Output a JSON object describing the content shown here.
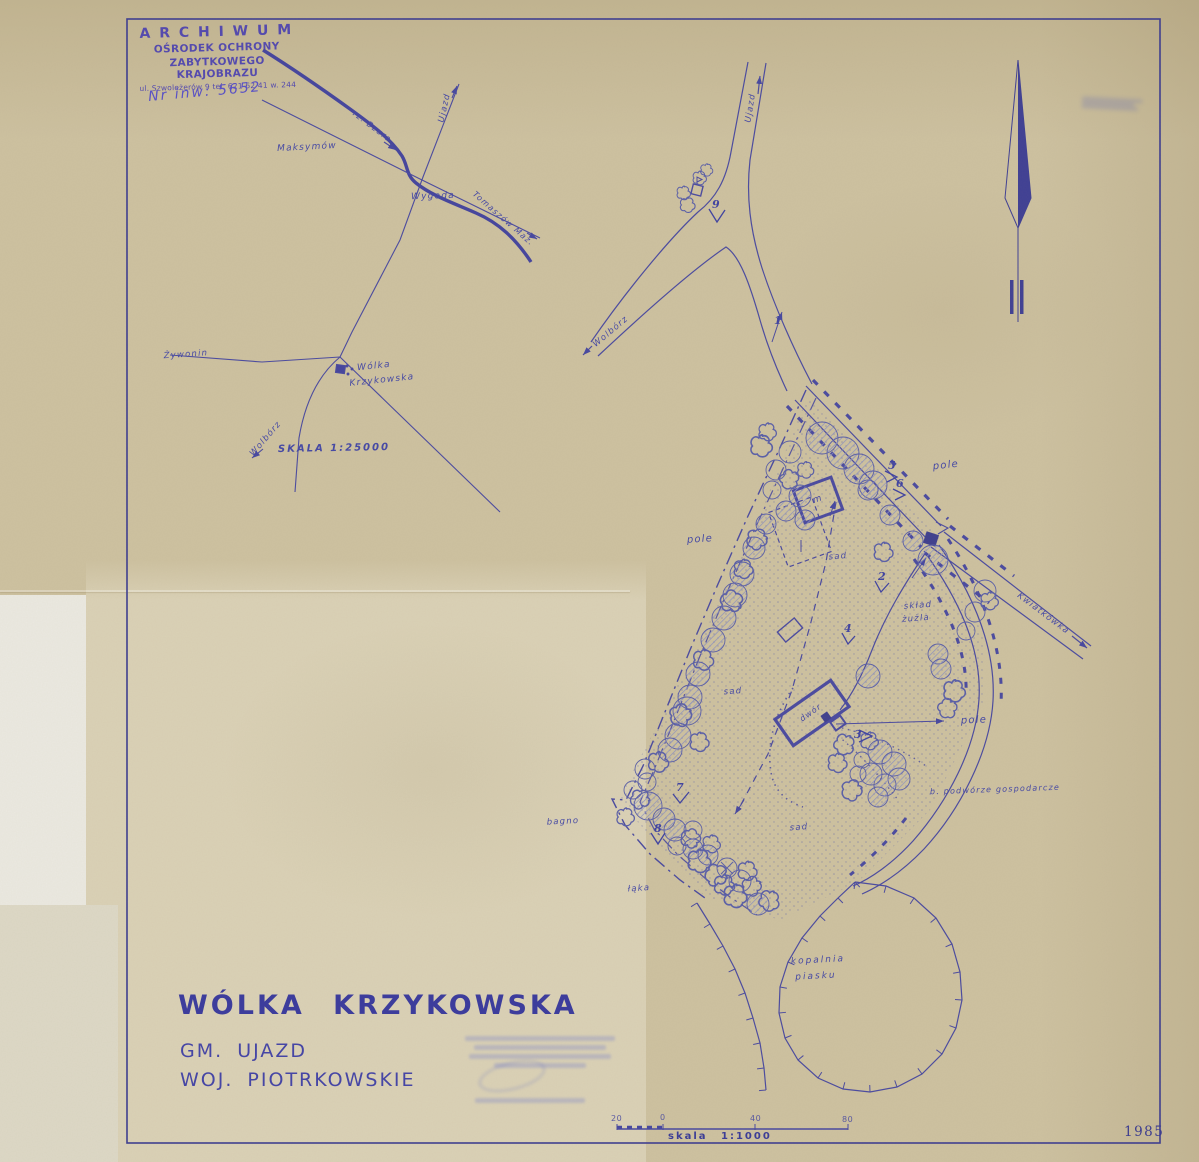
{
  "colors": {
    "paper": "#cdc1a0",
    "ink": "#4647a0",
    "title_ink": "#3d3d9c",
    "stamp_ink": "#4c42b0"
  },
  "archive_stamp": {
    "line1": "A R C H I W U M",
    "line2": "OŚRODEK OCHRONY",
    "line3": "ZABYTKOWEGO KRAJOBRAZU",
    "line4": "ul. Szwoleżerów 9  tel. 621 62 41 w. 244",
    "inventory_no": "Nr inw: 5652"
  },
  "sketch_map": {
    "scale_text": "SKALA  1:25000",
    "labels": {
      "maksymow": "Maksymów",
      "river": "rz. Bzura",
      "ujazd": "Ujazd",
      "wygoda": "Wygoda",
      "tomaszow": "Tomaszów Maz.",
      "zywonin": "Żywonin",
      "village_line1": "Wólka",
      "village_line2": "Krzykowska",
      "wolborz": "Wolbórz"
    }
  },
  "plan": {
    "road_labels": {
      "ujazd": "Ujazd",
      "wolborz": "Wolbórz",
      "kwiatkowka": "Kwiatkówka"
    },
    "area_labels": {
      "pole_nw": "pole",
      "pole_ne": "pole",
      "pole_e": "pole",
      "sad_n": "sad",
      "sad_w": "sad",
      "sad_s": "sad",
      "sklad_line1": "skład",
      "sklad_line2": "żużla",
      "bagno": "bagno",
      "laka": "łąka",
      "kopalnia_line1": "kopalnia",
      "kopalnia_line2": "piasku",
      "podworze": "b. podwórze gospodarcze"
    },
    "building_labels": {
      "dwor": "dwór",
      "m": "m"
    },
    "viewpoints": [
      "1",
      "2",
      "3",
      "4",
      "5",
      "6",
      "7",
      "8",
      "9"
    ]
  },
  "title_block": {
    "locality": "WÓLKA  KRZYKOWSKA",
    "commune": "GM. UJAZD",
    "voivodeship": "WOJ. PIOTRKOWSKIE"
  },
  "scale_bar": {
    "tick0": "20",
    "tick1": "0",
    "tick2": "40",
    "tick3": "80",
    "caption": "skala  1:1000"
  },
  "year": "1985"
}
